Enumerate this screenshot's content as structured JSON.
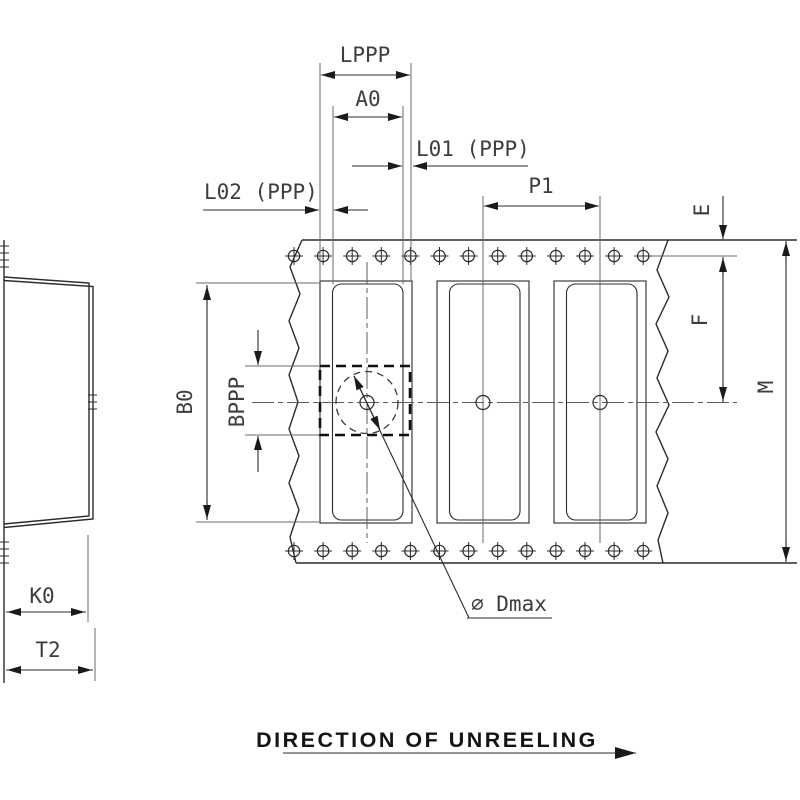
{
  "drawing": {
    "caption": "DIRECTION OF UNREELING",
    "labels": {
      "lppp": "LPPP",
      "a0": "A0",
      "l01": "L01 (PPP)",
      "l02": "L02 (PPP)",
      "p1": "P1",
      "e": "E",
      "f": "F",
      "m": "M",
      "b0": "B0",
      "bppp": "BPPP",
      "k0": "K0",
      "t2": "T2",
      "dmax": "⌀ Dmax"
    },
    "colors": {
      "background": "#ffffff",
      "line": "#2b2b2b",
      "dim_text": "#3d3d3d"
    }
  }
}
